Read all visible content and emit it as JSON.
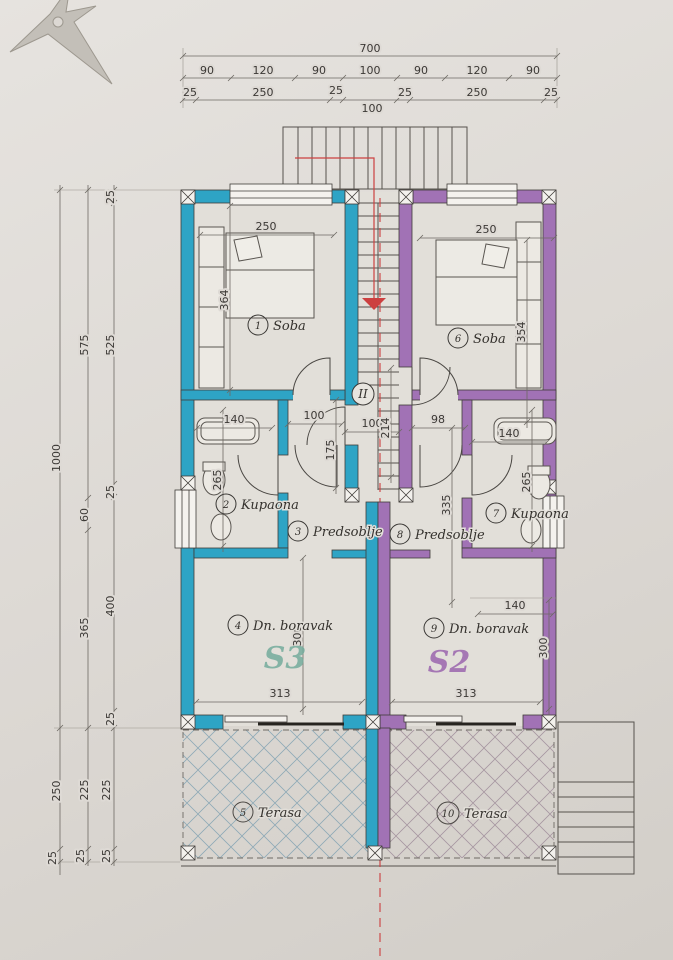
{
  "drawing": {
    "units": {
      "left": {
        "label": "S3"
      },
      "right": {
        "label": "S2"
      }
    },
    "stairwell": {
      "num": "II"
    },
    "rooms": {
      "soba_l": {
        "num": "1",
        "name": "Soba"
      },
      "kupaona_l": {
        "num": "2",
        "name": "Kupaona"
      },
      "predsoblje_l": {
        "num": "3",
        "name": "Predsoblje"
      },
      "boravak_l": {
        "num": "4",
        "name": "Dn. boravak"
      },
      "terasa_l": {
        "num": "5",
        "name": "Terasa"
      },
      "soba_r": {
        "num": "6",
        "name": "Soba"
      },
      "kupaona_r": {
        "num": "7",
        "name": "Kupaona"
      },
      "predsoblje_r": {
        "num": "8",
        "name": "Predsoblje"
      },
      "boravak_r": {
        "num": "9",
        "name": "Dn. boravak"
      },
      "terasa_r": {
        "num": "10",
        "name": "Terasa"
      }
    },
    "dims": {
      "top_total": "700",
      "top_row2": [
        "90",
        "120",
        "90",
        "100",
        "90",
        "120",
        "90"
      ],
      "top_row3": [
        "25",
        "250",
        "25",
        "100",
        "25",
        "250",
        "25"
      ],
      "left_outer": [
        "1000",
        "250",
        "25"
      ],
      "left_middle": [
        "575",
        "60",
        "365",
        "225",
        "25"
      ],
      "left_inner": [
        "25",
        "525",
        "25",
        "400",
        "25",
        "225",
        "25"
      ],
      "interior": {
        "soba_l_w": "250",
        "soba_l_h": "364",
        "soba_r_w": "250",
        "soba_r_h": "354",
        "kupaona_l_w": "140",
        "kupaona_l_h": "265",
        "kupaona_r_w": "140",
        "kupaona_r_h": "265",
        "predsoblje_l_w": "100",
        "predsoblje_l_h": "175",
        "stair_w": "100",
        "stair_h": "214",
        "predsoblje_r_w": "98",
        "predsoblje_r_h": "335",
        "boravak_l_h": "300",
        "boravak_r_w": "140",
        "boravak_r_h": "300",
        "glass_l": "313",
        "glass_r": "313"
      }
    },
    "colors": {
      "unit_left": "#2ea4c5",
      "unit_right": "#a172b5",
      "centerline": "#cc4040",
      "s3_text": "#74ac9c",
      "s2_text": "#9b66ae",
      "hatch_left": "#87a5b4",
      "hatch_right": "#a2909c"
    }
  }
}
